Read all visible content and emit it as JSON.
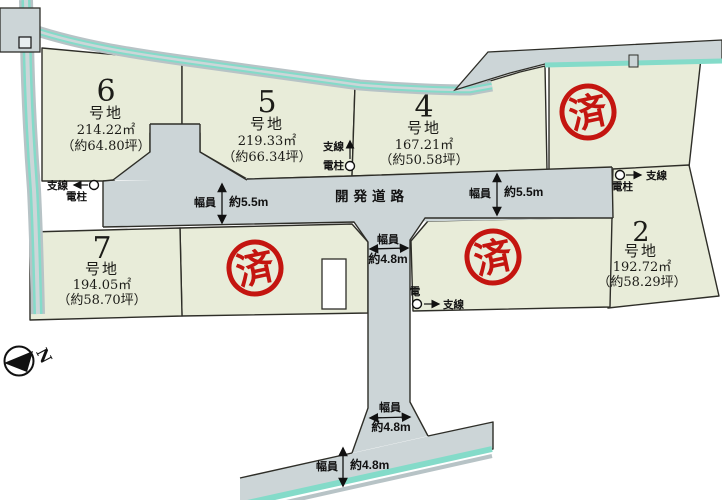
{
  "map": {
    "road_label": "開発道路",
    "sold_stamp": "済",
    "compass_label": "N",
    "plots": [
      {
        "number": "6",
        "suffix": "号地",
        "area": "214.22㎡",
        "tsubo": "（約64.80坪）",
        "status": "available"
      },
      {
        "number": "5",
        "suffix": "号地",
        "area": "219.33㎡",
        "tsubo": "（約66.34坪）",
        "status": "available"
      },
      {
        "number": "4",
        "suffix": "号地",
        "area": "167.21㎡",
        "tsubo": "（約50.58坪）",
        "status": "available"
      },
      {
        "number": "7",
        "suffix": "号地",
        "area": "194.05㎡",
        "tsubo": "（約58.70坪）",
        "status": "available"
      },
      {
        "number": "2",
        "suffix": "号地",
        "area": "192.72㎡",
        "tsubo": "（約58.29坪）",
        "status": "available"
      }
    ],
    "sold_plots": [
      {
        "location": "north-east"
      },
      {
        "location": "center-west"
      },
      {
        "location": "center-east"
      }
    ],
    "dimensions": [
      {
        "label": "幅員",
        "value": "約5.5m",
        "location": "main-road-west"
      },
      {
        "label": "幅員",
        "value": "約5.5m",
        "location": "main-road-east"
      },
      {
        "label": "幅員",
        "value": "約4.8m",
        "location": "branch-road-north"
      },
      {
        "label": "幅員",
        "value": "約4.8m",
        "location": "branch-road-south"
      },
      {
        "label": "幅員",
        "value": "約4.8m",
        "location": "south-boundary-road"
      }
    ],
    "utilities": [
      {
        "pole_label": "電柱",
        "line_label": "支線",
        "location": "west"
      },
      {
        "pole_label": "電柱",
        "line_label": "支線",
        "location": "north-center"
      },
      {
        "pole_label": "電柱",
        "line_label": "支線",
        "location": "east"
      },
      {
        "pole_label": "電",
        "line_label": "支線",
        "location": "center"
      }
    ],
    "colors": {
      "plot_fill": "#e8ecd9",
      "road_fill": "#ccd5d7",
      "stream_teal": "#84dbc9",
      "stamp_red": "#c41510",
      "outline": "#2e2e28"
    }
  }
}
